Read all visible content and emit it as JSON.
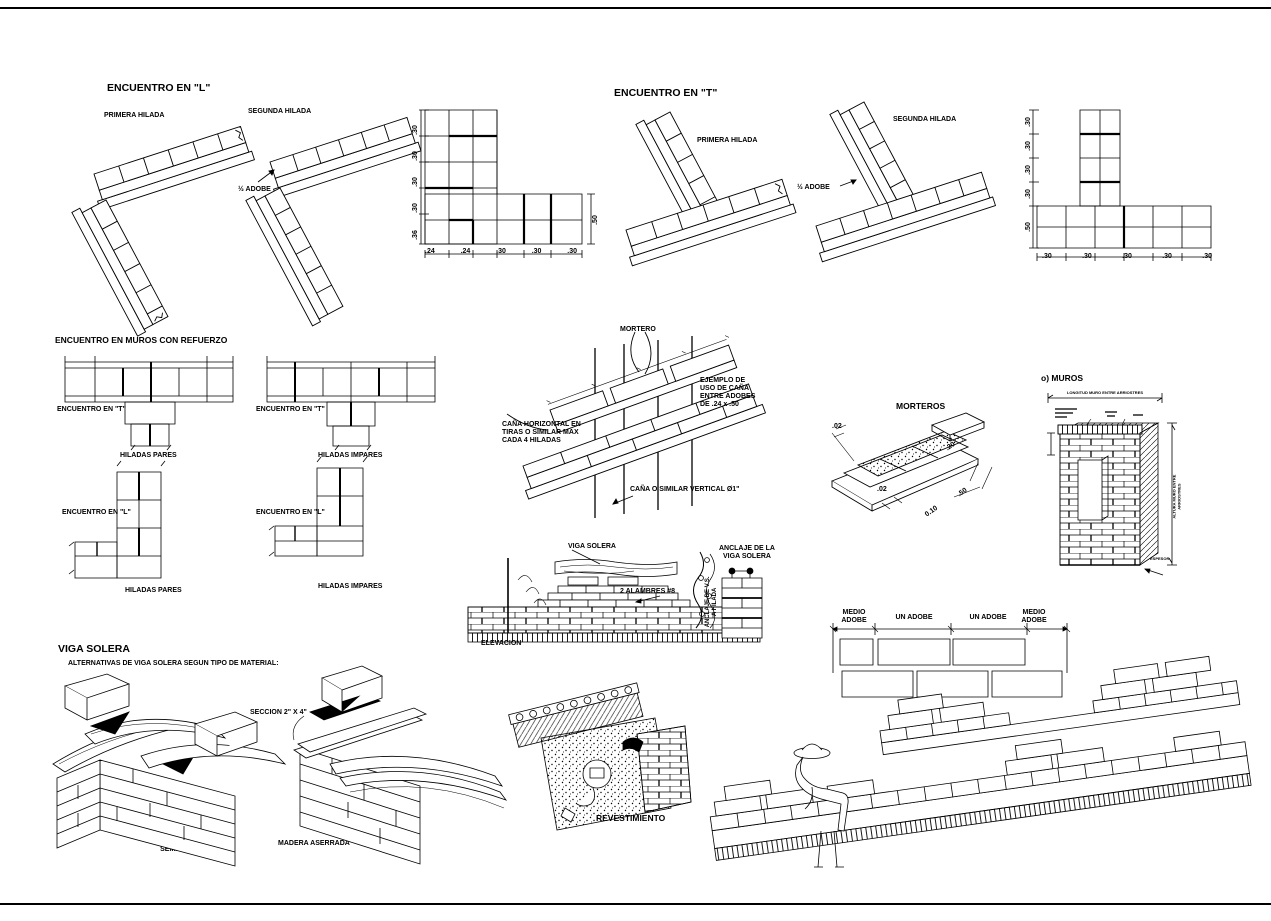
{
  "sheet": {
    "background": "#ffffff",
    "ink": "#000000"
  },
  "encuentro_l": {
    "title": "ENCUENTRO EN \"L\"",
    "primera_hilada": "PRIMERA HILADA",
    "segunda_hilada": "SEGUNDA HILADA",
    "half_adobe": "½ ADOBE",
    "plan": {
      "dims_left": [
        ".30",
        ".30",
        ".30",
        ".30",
        ".36"
      ],
      "dims_bottom": [
        ".24",
        ".24",
        ".30",
        ".30",
        ".30"
      ],
      "dim_right": ".50"
    }
  },
  "encuentro_t": {
    "title": "ENCUENTRO EN \"T\"",
    "primera_hilada": "PRIMERA HILADA",
    "segunda_hilada": "SEGUNDA HILADA",
    "half_adobe": "½ ADOBE",
    "plan": {
      "dims_left": [
        ".30",
        ".30",
        ".30",
        ".30",
        ".50"
      ],
      "dims_bottom": [
        ".30",
        ".30",
        ".30",
        ".30",
        ".30"
      ]
    }
  },
  "muros_refuerzo": {
    "title": "ENCUENTRO EN MUROS CON REFUERZO",
    "t_pares": {
      "label": "ENCUENTRO EN \"T\"",
      "sub": "HILADAS PARES"
    },
    "t_impares": {
      "label": "ENCUENTRO EN \"T\"",
      "sub": "HILADAS IMPARES"
    },
    "l_pares": {
      "label": "ENCUENTRO EN \"L\"",
      "sub": "HILADAS PARES"
    },
    "l_impares": {
      "label": "ENCUENTRO EN \"L\"",
      "sub": "HILADAS IMPARES"
    }
  },
  "cana": {
    "mortero": "MORTERO",
    "ejemplo": "EJEMPLO DE\nUSO DE CAÑA\nENTRE ADOBES\nDE .24 x .50",
    "horizontal": "CAÑA HORIZONTAL EN\nTIRAS O SIMILAR MAX\nCADA 4 HILADAS",
    "vertical": "CAÑA O SIMILAR VERTICAL Ø1\""
  },
  "morteros": {
    "title": "MORTEROS",
    "dim_left": ".02",
    "dim_bottom": ".02",
    "dim_width": "0.10",
    "dim_length": ".50",
    "dim_height": ".20"
  },
  "muros": {
    "title": "o) MUROS",
    "dim_top": "LONGITUD MURO ENTRE ARRIOSTRES",
    "dim_right": "ALTURA MURO ENTRE ARRIOSTRES",
    "label_bottom": "ESPESOR"
  },
  "viga_elevacion": {
    "viga_solera": "VIGA SOLERA",
    "alambres": "2 ALAMBRES #8",
    "elevacion": "ELEVACION",
    "anclaje_title": "ANCLAJE DE LA\nVIGA SOLERA",
    "anclaje_lateral": "ANCLAJE DE V.S.\nA HILADA"
  },
  "viga_alternativas": {
    "title": "VIGA SOLERA",
    "subtitle": "ALTERNATIVAS DE VIGA SOLERA SEGUN TIPO DE MATERIAL:",
    "seccion": "SECCION 2\" X 4\"",
    "madera_rustica": "MADERA RUSTICA\nSEMILABRADA",
    "madera_aserrada": "MADERA ASERRADA"
  },
  "revestimiento": {
    "title": "REVESTIMIENTO"
  },
  "aparejo": {
    "labels": [
      "MEDIO\nADOBE",
      "UN ADOBE",
      "UN ADOBE",
      "MEDIO\nADOBE"
    ]
  }
}
